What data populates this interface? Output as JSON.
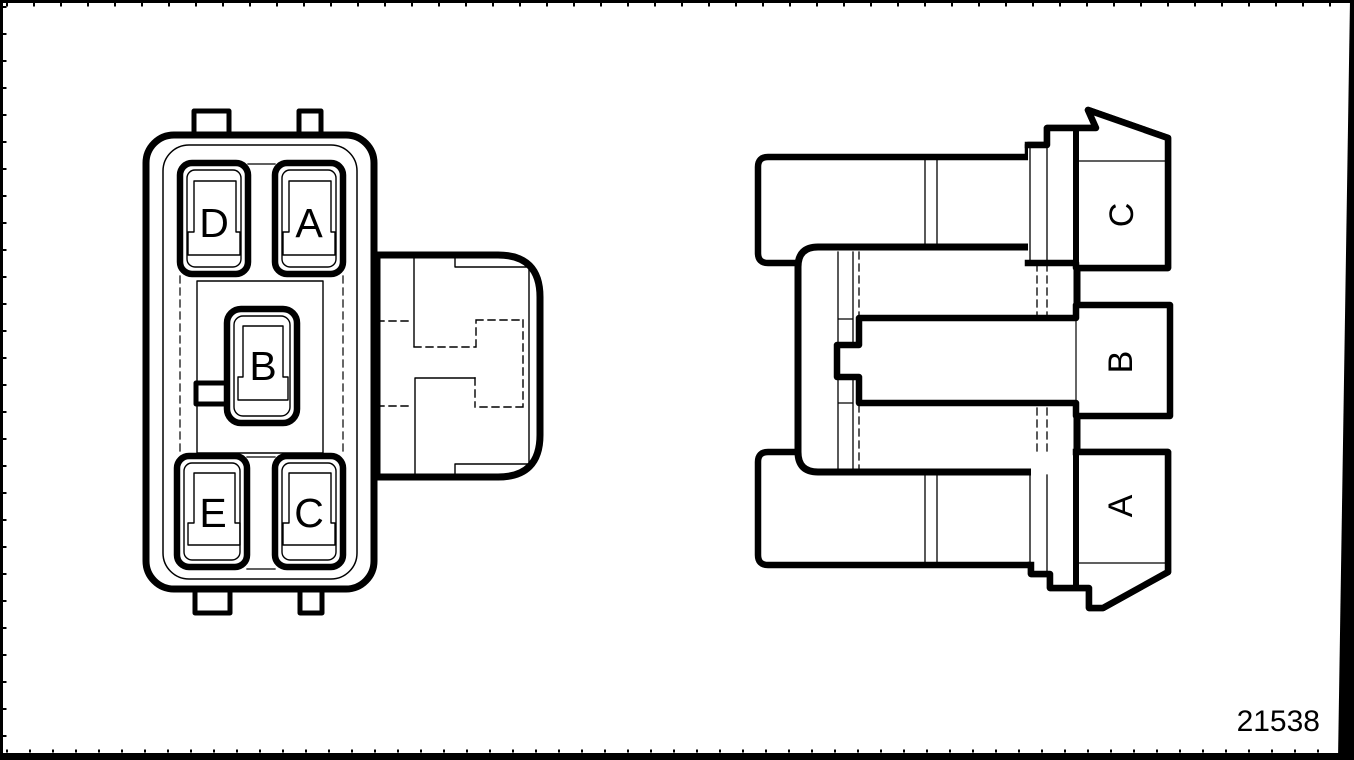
{
  "colors": {
    "line": "#000000",
    "background": "#ffffff"
  },
  "left_connector": {
    "cavities": [
      {
        "label": "D"
      },
      {
        "label": "A"
      },
      {
        "label": "B"
      },
      {
        "label": "E"
      },
      {
        "label": "C"
      }
    ]
  },
  "right_connector": {
    "terminals": [
      {
        "label": "C"
      },
      {
        "label": "B"
      },
      {
        "label": "A"
      }
    ]
  },
  "figure": {
    "number": "21538"
  }
}
